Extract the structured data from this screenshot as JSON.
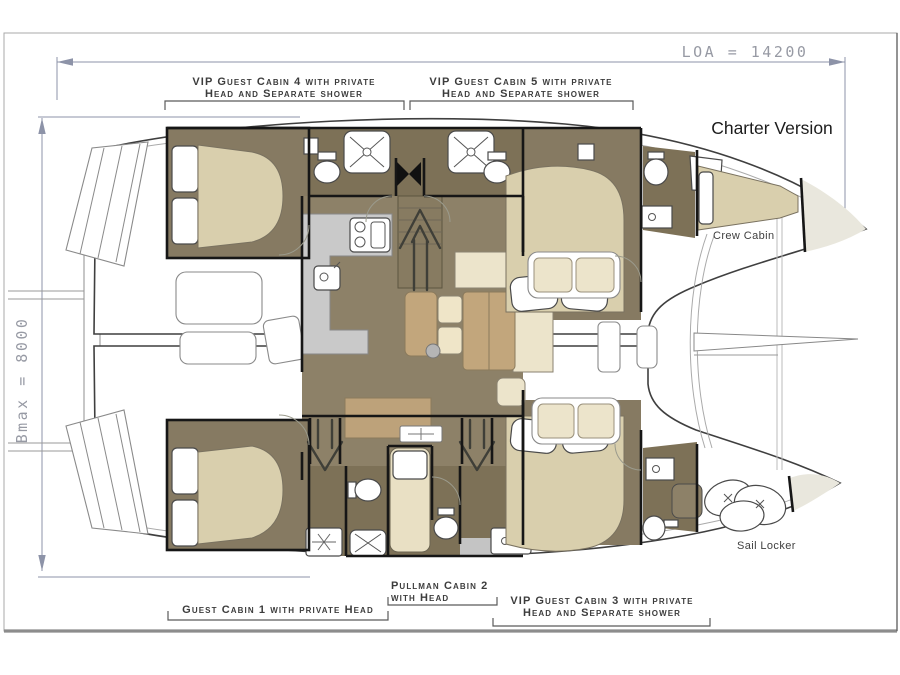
{
  "drawing": {
    "title": "Charter Version",
    "dimensions": {
      "loa_label": "LOA = 14200",
      "bmax_label": "Bmax = 8000"
    },
    "areas": {
      "crew_cabin": "Crew Cabin",
      "sail_locker": "Sail  Locker"
    },
    "cabin_callouts": [
      {
        "id": "cabin4",
        "line1": "VIP Guest Cabin 4 with private",
        "line2": "Head and Separate shower"
      },
      {
        "id": "cabin5",
        "line1": "VIP Guest Cabin 5 with private",
        "line2": "Head and Separate shower"
      },
      {
        "id": "cabin1",
        "line1": "Guest Cabin 1 with private Head",
        "line2": ""
      },
      {
        "id": "pullman2",
        "line1": "Pullman Cabin 2",
        "line2": "with Head"
      },
      {
        "id": "cabin3",
        "line1": "VIP Guest Cabin 3 with private",
        "line2": "Head and Separate shower"
      }
    ],
    "colors": {
      "bed_beige": "#d9cfad",
      "salon_floor": "#8d8168",
      "cabin_floor": "#867a62",
      "head_floor": "#7d7157",
      "galley_counter": "#c9c9c9",
      "sofa_cream": "#ece4cb",
      "table_tan": "#c2a67c",
      "pullman_cream": "#e9e0c4",
      "bow_deck": "#e9e7dd",
      "dimension_gray": "#8d93a8",
      "wall_black": "#161616"
    }
  }
}
